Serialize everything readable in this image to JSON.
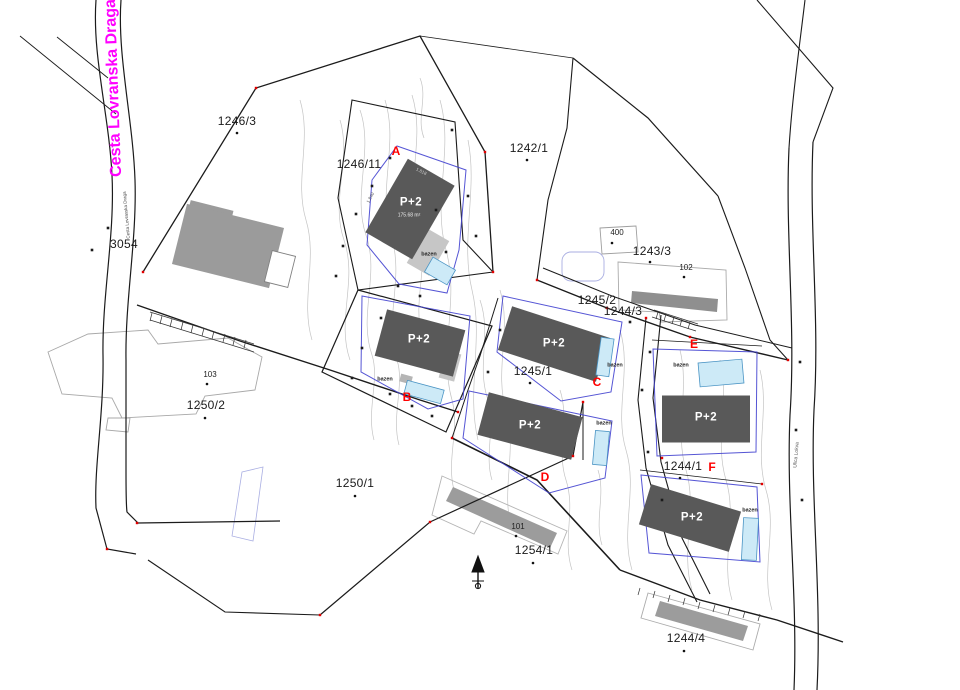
{
  "streets": {
    "cesta": "Cesta Lovranska Draga",
    "cesta_small": "Cesta Lovranska Draga",
    "ulica": "Ulica Lokva"
  },
  "parcels": {
    "p1246_3": "1246/3",
    "p1246_11": "1246/11",
    "p1242_1": "1242/1",
    "p1243_3": "1243/3",
    "p1245_2": "1245/2",
    "p1244_3": "1244/3",
    "p1245_1": "1245/1",
    "p1250_2": "1250/2",
    "p1250_1": "1250/1",
    "p1254_1": "1254/1",
    "p1244_1": "1244/1",
    "p1244_4": "1244/4",
    "p3054": "3054"
  },
  "existing_buildings": {
    "n400": "400",
    "n102": "102",
    "n103": "103",
    "n101": "101"
  },
  "unit_markers": {
    "a": "A",
    "b": "B",
    "c": "C",
    "d": "D",
    "e": "E",
    "f": "F"
  },
  "planned": {
    "floors": "P+2",
    "area_a": "175.68 m²",
    "dim_a_left": "1.840",
    "dim_a_top": "1.818"
  },
  "features": {
    "pool": "bazen"
  },
  "colors": {
    "street_name": "#ff00ff",
    "unit_marker": "#ff0000",
    "planned_building": "#595959",
    "existing_building": "#9b9b9b",
    "pool_fill": "#cdeaf7",
    "pool_border": "#4a94c4",
    "plot_boundary": "#4343d0",
    "parcel_line": "#1b1b1b",
    "contour": "#c4c4c4"
  }
}
